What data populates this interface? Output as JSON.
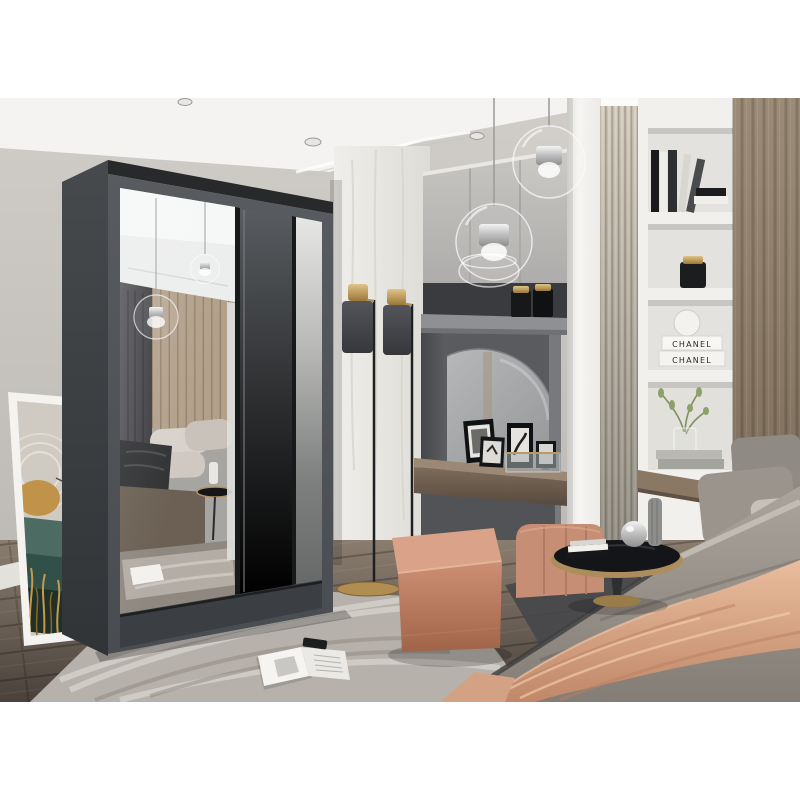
{
  "meta": {
    "description": "Bedroom interior product photograph: graphite two-door sliding wardrobe with mirror, dressing nook, shelving and bed",
    "canvas": "800x800",
    "photo_area": {
      "top": 98,
      "bottom": 702
    }
  },
  "texts": {
    "chanel_book_top": "CHANEL",
    "chanel_book_bottom": "CHANEL"
  },
  "palette": {
    "canvas": "#ffffff",
    "ceiling": "#f4f3f1",
    "wall_left": "#c7c4bf",
    "marble_panel": "#edebe7",
    "cabinets": "#c2c0bd",
    "nook_recess": "#595b5e",
    "console_wood": "#84725f",
    "ribbed_panel": "#c9c2b4",
    "shelf_unit": "#f1f0ed",
    "headboard_wood": "#94846f",
    "wardrobe_frame": "#53565a",
    "wardrobe_side": "#3f4245",
    "wardrobe_door_grey": "#63666a",
    "floor_wood": "#6e6358",
    "rug": "#b6b1aa",
    "pouf": "#c98a72",
    "blanket": "#d8a88c",
    "duvet": "#9d968e",
    "art_teal": "#3f625b",
    "art_gold": "#c0924a",
    "lamp_gold": "#c2a169",
    "candle_gold": "#b59357"
  },
  "objects": {
    "wardrobe": {
      "label": "graphite sliding-door wardrobe, left door mirrored"
    },
    "mirror_reflection": {
      "label": "mirror reflects bed, pendant lamps, curtain, slat wall, rug and magazine"
    },
    "wall_art": {
      "label": "framed abstract art (gold sun, teal mountains, gold grasses) leaning on wall"
    },
    "pendant_lights": {
      "label": "two clear glass globe pendant lamps"
    },
    "spotlights": {
      "label": "recessed ceiling spotlights"
    },
    "cabinets": {
      "label": "grey wall-hung cabinets"
    },
    "glass_bowl": {
      "label": "clear glass bowl on ledge"
    },
    "candle_jars": {
      "label": "black candle jars with gold lids"
    },
    "vanity_nook": {
      "label": "dark recessed dressing nook"
    },
    "round_mirror": {
      "label": "round vanity mirror"
    },
    "console": {
      "label": "floating wood vanity shelf"
    },
    "photo_frames": {
      "label": "black framed monochrome photos"
    },
    "glass_box": {
      "label": "glass trinket box"
    },
    "pilaster": {
      "label": "white wall column"
    },
    "ribbed_panel": {
      "label": "fluted beige wall panel"
    },
    "shelf_unit": {
      "label": "white built-in shelving niche"
    },
    "books_black_white": {
      "label": "black and white decor books"
    },
    "deco_sphere": {
      "label": "white decorative sphere"
    },
    "chanel_books": {
      "label": "two white CHANEL books"
    },
    "plant": {
      "label": "green sprigs in glass vase on stacked books"
    },
    "headboard_panel": {
      "label": "wood headboard wall panel"
    },
    "bed": {
      "label": "bed with grey bedding and pillows"
    },
    "blanket": {
      "label": "blush satin throw blanket"
    },
    "side_table": {
      "label": "round black-top table with gold rim, books and vases"
    },
    "vanity_chair": {
      "label": "blush upholstered chair"
    },
    "pouf": {
      "label": "terracotta cube pouf"
    },
    "floor_lamps": {
      "label": "two slim floor lamps, grey shade with gold top"
    },
    "rug": {
      "label": "marbled grey rug"
    },
    "magazine": {
      "label": "open magazine with remote on rug"
    },
    "floor": {
      "label": "grey-brown wood plank floor"
    }
  }
}
